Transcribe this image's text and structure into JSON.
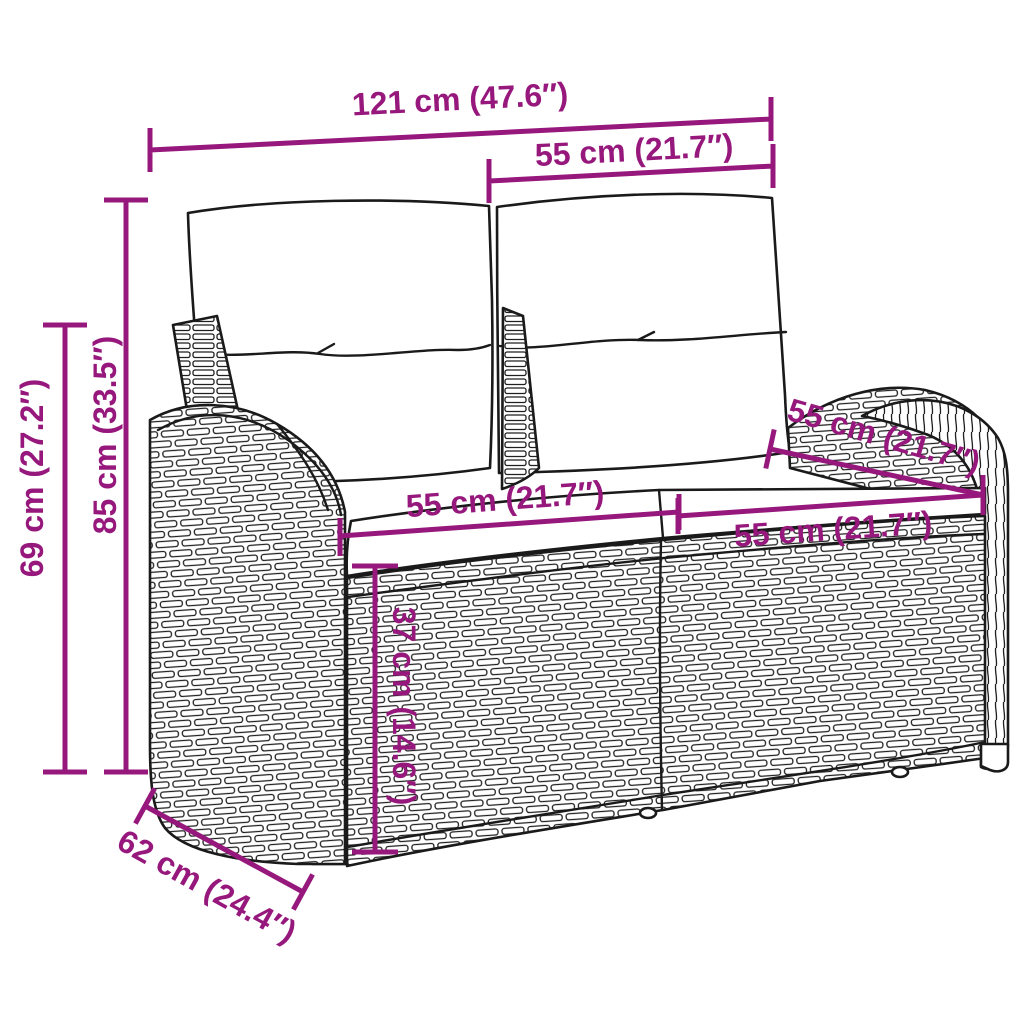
{
  "diagram": {
    "type": "product-dimension-diagram",
    "subject": "2-seater rattan garden bench with back and seat cushions"
  },
  "colors": {
    "dimension": "#97187C",
    "line_art": "#1a1a1a",
    "background": "#ffffff"
  },
  "dimensions": {
    "overall_width": "121 cm (47.6″)",
    "backrest_section_width": "55 cm (21.7″)",
    "height_total": "85 cm (33.5″)",
    "height_arm": "69 cm (27.2″)",
    "seat_width_left": "55 cm (21.7″)",
    "seat_width_right": "55 cm (21.7″)",
    "seat_depth_back": "55 cm (21.7″)",
    "seat_height": "37 cm (14.6″)",
    "overall_depth": "62 cm (24.4″)"
  }
}
